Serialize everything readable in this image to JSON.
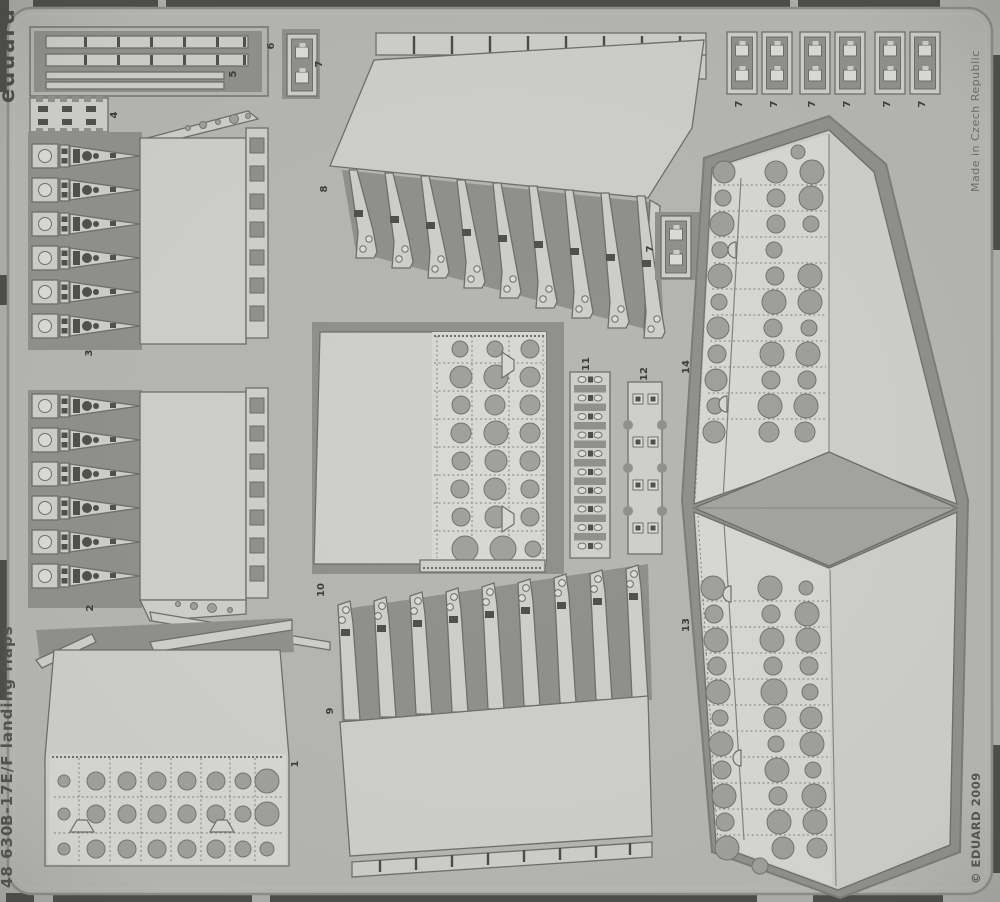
{
  "texts": {
    "brand_logo": "eduard",
    "set_code": "48 630",
    "set_title": "B-17E/F landing flaps",
    "made_in": "Made in Czech Republic",
    "copyright": "© EDUARD 2009"
  },
  "part_labels": {
    "p1": "1",
    "p2": "2",
    "p3": "3",
    "p4": "4",
    "p5": "5",
    "p6": "6",
    "p7": "7",
    "p8": "8",
    "p9": "9",
    "p10": "10",
    "p11": "11",
    "p12": "12",
    "p13": "13",
    "p14": "14"
  },
  "colors": {
    "background": "#aeaeac",
    "plate": "#b6b6b4",
    "etched_web": "#90908e",
    "part_surface": "#cfcfcd",
    "part_skin_light": "#d8d8d6",
    "hole": "#a0a09e",
    "outline": "#6e6e6c",
    "dark_detail": "#4f4f4d",
    "photo_edge_bars": "#4c4c4a",
    "label_text": "#3c3c3a"
  }
}
